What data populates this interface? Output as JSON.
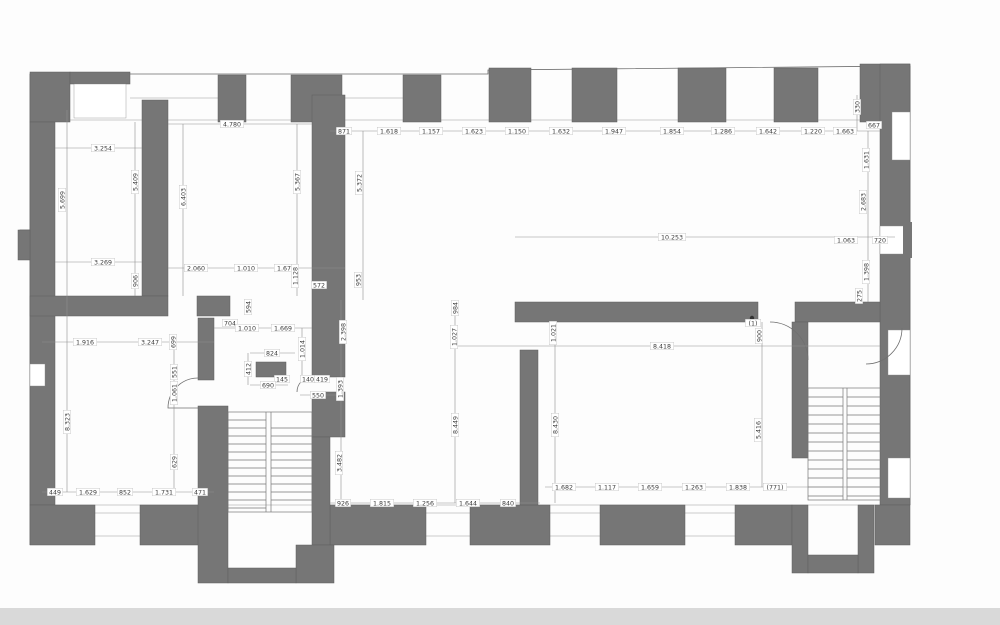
{
  "drawing": {
    "type": "architectural floor plan",
    "colors": {
      "wall": "#767676",
      "line": "#8f8f8f",
      "text": "#3b3b3b",
      "background": "#ffffff",
      "footer_strip": "#d9d9d9"
    }
  },
  "dimensions": {
    "horizontal": [
      {
        "x": 103,
        "y": 148,
        "t": "3.254"
      },
      {
        "x": 232,
        "y": 124,
        "t": "4.780"
      },
      {
        "x": 344,
        "y": 131,
        "t": "871"
      },
      {
        "x": 389,
        "y": 131,
        "t": "1.618"
      },
      {
        "x": 431,
        "y": 131,
        "t": "1.157"
      },
      {
        "x": 474,
        "y": 131,
        "t": "1.623"
      },
      {
        "x": 517,
        "y": 131,
        "t": "1.150"
      },
      {
        "x": 561,
        "y": 131,
        "t": "1.632"
      },
      {
        "x": 614,
        "y": 131,
        "t": "1.947"
      },
      {
        "x": 672,
        "y": 131,
        "t": "1.854"
      },
      {
        "x": 723,
        "y": 131,
        "t": "1.286"
      },
      {
        "x": 768,
        "y": 131,
        "t": "1.642"
      },
      {
        "x": 813,
        "y": 131,
        "t": "1.220"
      },
      {
        "x": 845,
        "y": 131,
        "t": "1.663"
      },
      {
        "x": 874,
        "y": 125,
        "t": "667"
      },
      {
        "x": 672,
        "y": 237,
        "t": "10.253"
      },
      {
        "x": 846,
        "y": 240,
        "t": "1.063"
      },
      {
        "x": 880,
        "y": 240,
        "t": "720"
      },
      {
        "x": 103,
        "y": 262,
        "t": "3.269"
      },
      {
        "x": 196,
        "y": 268,
        "t": "2.060"
      },
      {
        "x": 246,
        "y": 268,
        "t": "1.010"
      },
      {
        "x": 286,
        "y": 268,
        "t": "1.673"
      },
      {
        "x": 319,
        "y": 285,
        "t": "572"
      },
      {
        "x": 230,
        "y": 323,
        "t": "704"
      },
      {
        "x": 247,
        "y": 328,
        "t": "1.010"
      },
      {
        "x": 283,
        "y": 328,
        "t": "1.669"
      },
      {
        "x": 85,
        "y": 342,
        "t": "1.916"
      },
      {
        "x": 150,
        "y": 342,
        "t": "3.247"
      },
      {
        "x": 662,
        "y": 346,
        "t": "8.418"
      },
      {
        "x": 272,
        "y": 353,
        "t": "824"
      },
      {
        "x": 282,
        "y": 379,
        "t": "145"
      },
      {
        "x": 308,
        "y": 379,
        "t": "140"
      },
      {
        "x": 322,
        "y": 379,
        "t": "419"
      },
      {
        "x": 268,
        "y": 385,
        "t": "690"
      },
      {
        "x": 318,
        "y": 395,
        "t": "550"
      },
      {
        "x": 753,
        "y": 323,
        "t": "(1)"
      },
      {
        "x": 55,
        "y": 492,
        "t": "449"
      },
      {
        "x": 88,
        "y": 492,
        "t": "1.629"
      },
      {
        "x": 125,
        "y": 492,
        "t": "852"
      },
      {
        "x": 164,
        "y": 492,
        "t": "1.731"
      },
      {
        "x": 200,
        "y": 492,
        "t": "471"
      },
      {
        "x": 343,
        "y": 503,
        "t": "926"
      },
      {
        "x": 382,
        "y": 503,
        "t": "1.815"
      },
      {
        "x": 425,
        "y": 503,
        "t": "1.256"
      },
      {
        "x": 468,
        "y": 503,
        "t": "1.644"
      },
      {
        "x": 508,
        "y": 503,
        "t": "840"
      },
      {
        "x": 564,
        "y": 487,
        "t": "1.682"
      },
      {
        "x": 607,
        "y": 487,
        "t": "1.117"
      },
      {
        "x": 650,
        "y": 487,
        "t": "1.659"
      },
      {
        "x": 694,
        "y": 487,
        "t": "1.263"
      },
      {
        "x": 738,
        "y": 487,
        "t": "1.838"
      },
      {
        "x": 775,
        "y": 487,
        "t": "(771)"
      }
    ],
    "vertical": [
      {
        "x": 62,
        "y": 200,
        "t": "5.699"
      },
      {
        "x": 135,
        "y": 182,
        "t": "5.409"
      },
      {
        "x": 135,
        "y": 281,
        "t": "906"
      },
      {
        "x": 183,
        "y": 197,
        "t": "6.403"
      },
      {
        "x": 297,
        "y": 182,
        "t": "5.367"
      },
      {
        "x": 295,
        "y": 276,
        "t": "1.128"
      },
      {
        "x": 359,
        "y": 183,
        "t": "5.372"
      },
      {
        "x": 358,
        "y": 280,
        "t": "953"
      },
      {
        "x": 857,
        "y": 107,
        "t": "330"
      },
      {
        "x": 866,
        "y": 160,
        "t": "1.631"
      },
      {
        "x": 863,
        "y": 202,
        "t": "2.683"
      },
      {
        "x": 866,
        "y": 272,
        "t": "1.398"
      },
      {
        "x": 859,
        "y": 296,
        "t": "275"
      },
      {
        "x": 343,
        "y": 332,
        "t": "2.398"
      },
      {
        "x": 340,
        "y": 389,
        "t": "1.393"
      },
      {
        "x": 339,
        "y": 463,
        "t": "3.482"
      },
      {
        "x": 248,
        "y": 307,
        "t": "594"
      },
      {
        "x": 173,
        "y": 342,
        "t": "699"
      },
      {
        "x": 174,
        "y": 372,
        "t": "551"
      },
      {
        "x": 174,
        "y": 393,
        "t": "1.061"
      },
      {
        "x": 67,
        "y": 422,
        "t": "8.323"
      },
      {
        "x": 174,
        "y": 462,
        "t": "629"
      },
      {
        "x": 455,
        "y": 308,
        "t": "984"
      },
      {
        "x": 454,
        "y": 337,
        "t": "1.027"
      },
      {
        "x": 553,
        "y": 333,
        "t": "1.021"
      },
      {
        "x": 455,
        "y": 425,
        "t": "8.449"
      },
      {
        "x": 555,
        "y": 425,
        "t": "8.430"
      },
      {
        "x": 759,
        "y": 336,
        "t": "900"
      },
      {
        "x": 758,
        "y": 430,
        "t": "5.416"
      },
      {
        "x": 302,
        "y": 349,
        "t": "1.014"
      },
      {
        "x": 248,
        "y": 369,
        "t": "412"
      }
    ]
  }
}
